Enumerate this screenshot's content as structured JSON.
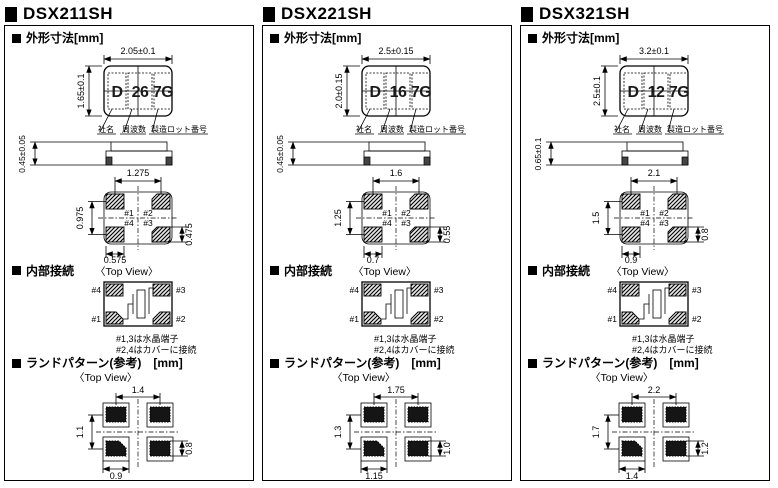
{
  "page": {
    "background": "#ffffff",
    "line_color": "#000000"
  },
  "columns": [
    {
      "title": "DSX211SH",
      "outline_title": "外形寸法[mm]",
      "internal_title": "内部接続",
      "land_title": "ランドパターン(参考)　[mm]",
      "top_view_label": "〈Top View〉",
      "marking": {
        "chars": [
          "D",
          "26",
          "7G"
        ],
        "labels": [
          "社名",
          "周波数",
          "製造ロット番号"
        ]
      },
      "dims": {
        "body_width": "2.05±0.1",
        "body_height": "1.65±0.1",
        "thickness": "0.45±0.05",
        "bv_pitch_x": "1.275",
        "bv_pitch_y": "0.975",
        "bv_pad_w": "0.575",
        "bv_pad_h": "0.475"
      },
      "bottom_view_pins": {
        "top_left": "#1",
        "top_right": "#2",
        "bottom_left": "#4",
        "bottom_right": "#3"
      },
      "internal_pins": {
        "top_left": "#4",
        "top_right": "#3",
        "bottom_left": "#1",
        "bottom_right": "#2"
      },
      "internal_notes": [
        "#1,3は水晶端子",
        "#2,4はカバーに接続"
      ],
      "land_dims": {
        "pitch_x": "1.4",
        "pitch_y": "1.1",
        "pad_w": "0.9",
        "pad_h": "0.8"
      }
    },
    {
      "title": "DSX221SH",
      "outline_title": "外形寸法[mm]",
      "internal_title": "内部接続",
      "land_title": "ランドパターン(参考)　[mm]",
      "top_view_label": "〈Top View〉",
      "marking": {
        "chars": [
          "D",
          "16",
          "7G"
        ],
        "labels": [
          "社名",
          "周波数",
          "製造ロット番号"
        ]
      },
      "dims": {
        "body_width": "2.5±0.15",
        "body_height": "2.0±0.15",
        "thickness": "0.45±0.05",
        "bv_pitch_x": "1.6",
        "bv_pitch_y": "1.25",
        "bv_pad_w": "0.7",
        "bv_pad_h": "0.55"
      },
      "bottom_view_pins": {
        "top_left": "#1",
        "top_right": "#2",
        "bottom_left": "#4",
        "bottom_right": "#3"
      },
      "internal_pins": {
        "top_left": "#4",
        "top_right": "#3",
        "bottom_left": "#1",
        "bottom_right": "#2"
      },
      "internal_notes": [
        "#1,3は水晶端子",
        "#2,4はカバーに接続"
      ],
      "land_dims": {
        "pitch_x": "1.75",
        "pitch_y": "1.3",
        "pad_w": "1.15",
        "pad_h": "1.0"
      }
    },
    {
      "title": "DSX321SH",
      "outline_title": "外形寸法[mm]",
      "internal_title": "内部接続",
      "land_title": "ランドパターン(参考)　[mm]",
      "top_view_label": "〈Top View〉",
      "marking": {
        "chars": [
          "D",
          "12",
          "7G"
        ],
        "labels": [
          "社名",
          "周波数",
          "製造ロット番号"
        ]
      },
      "dims": {
        "body_width": "3.2±0.1",
        "body_height": "2.5±0.1",
        "thickness": "0.65±0.1",
        "bv_pitch_x": "2.1",
        "bv_pitch_y": "1.5",
        "bv_pad_w": "0.9",
        "bv_pad_h": "0.8"
      },
      "bottom_view_pins": {
        "top_left": "#1",
        "top_right": "#2",
        "bottom_left": "#4",
        "bottom_right": "#3"
      },
      "internal_pins": {
        "top_left": "#4",
        "top_right": "#3",
        "bottom_left": "#1",
        "bottom_right": "#2"
      },
      "internal_notes": [
        "#1,3は水晶端子",
        "#2,4はカバーに接続"
      ],
      "land_dims": {
        "pitch_x": "2.2",
        "pitch_y": "1.7",
        "pad_w": "1.4",
        "pad_h": "1.2"
      }
    }
  ]
}
